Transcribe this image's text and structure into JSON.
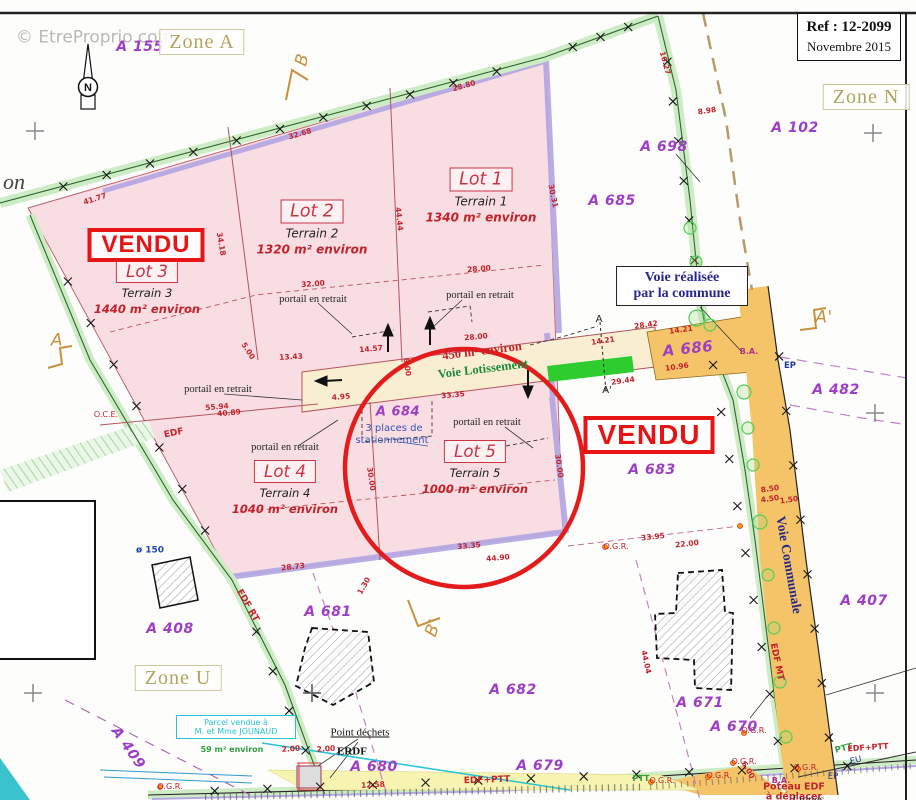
{
  "palette": {
    "pink": "#f8dee2",
    "lot_line": "#c06570",
    "purple_strip": "#b6a9e3",
    "hedge": "#cdebc5",
    "road_cream": "#f9eed2",
    "road_orange": "#f6c468",
    "bright_green": "#2ecc2e",
    "red_stamp": "#e61414",
    "parcel_purple": "#9d3fc4",
    "dim_red": "#c2232d",
    "dark_blue": "#28288c",
    "zone_tan": "#b3a25e",
    "cyan": "#27c4d4"
  },
  "header": {
    "watermark": "© EtreProprio.com",
    "ref_line1": "Ref :   12-2099",
    "ref_line2": "Novembre 2015"
  },
  "legend": {
    "line1": "ssement",
    "line2": "strale"
  },
  "compass": {
    "letter": "N"
  },
  "voie_box": {
    "line1": "Voie réalisée",
    "line2": "par la commune"
  },
  "cyan_box": {
    "line1": "Parcel vendue à",
    "line2": "M. et Mme JOUNAUD"
  },
  "zones": [
    {
      "label": "Zone A",
      "x": 202,
      "y": 42
    },
    {
      "label": "Zone N",
      "x": 866,
      "y": 97
    },
    {
      "label": "Zone U",
      "x": 178,
      "y": 678
    }
  ],
  "stamps": [
    {
      "label": "VENDU",
      "x": 146,
      "y": 245,
      "s": 24
    },
    {
      "label": "VENDU",
      "x": 649,
      "y": 435,
      "s": 28
    }
  ],
  "lots": [
    {
      "name": "Lot 1",
      "terrain": "Terrain 1",
      "area": "1340 m² environ",
      "x": 481,
      "y": 196,
      "s": 12
    },
    {
      "name": "Lot 2",
      "terrain": "Terrain 2",
      "area": "1320 m² environ",
      "x": 312,
      "y": 228,
      "s": 12
    },
    {
      "name": "Lot 3",
      "terrain": "Terrain 3",
      "area": "1440 m² environ",
      "x": 147,
      "y": 288,
      "s": 11.5
    },
    {
      "name": "Lot 4",
      "terrain": "Terrain 4",
      "area": "1040 m² environ",
      "x": 285,
      "y": 488,
      "s": 11.5
    },
    {
      "name": "Lot 5",
      "terrain": "Terrain 5",
      "area": "1000 m² environ",
      "x": 475,
      "y": 468,
      "s": 11.5
    }
  ],
  "parcels": [
    {
      "t": "A 155",
      "x": 140,
      "y": 47
    },
    {
      "t": "A 102",
      "x": 795,
      "y": 128
    },
    {
      "t": "A 698",
      "x": 664,
      "y": 147
    },
    {
      "t": "A 685",
      "x": 612,
      "y": 201
    },
    {
      "t": "A 686",
      "x": 688,
      "y": 349,
      "rot": -6,
      "s": 15
    },
    {
      "t": "A 482",
      "x": 836,
      "y": 390
    },
    {
      "t": "A 683",
      "x": 652,
      "y": 470
    },
    {
      "t": "A 684",
      "x": 398,
      "y": 412,
      "s": 13
    },
    {
      "t": "A 681",
      "x": 328,
      "y": 612
    },
    {
      "t": "A 682",
      "x": 513,
      "y": 690
    },
    {
      "t": "A 680",
      "x": 374,
      "y": 767
    },
    {
      "t": "A 679",
      "x": 540,
      "y": 766
    },
    {
      "t": "A 671",
      "x": 700,
      "y": 703
    },
    {
      "t": "A 670",
      "x": 734,
      "y": 727
    },
    {
      "t": "A 407",
      "x": 864,
      "y": 601
    },
    {
      "t": "A 408",
      "x": 170,
      "y": 629
    },
    {
      "t": "A 409",
      "x": 128,
      "y": 748,
      "rot": 55
    }
  ],
  "labels": [
    {
      "t": "© EtreProprio.com",
      "x": 95,
      "y": 38,
      "c": "rgba(160,160,160,.75)",
      "s": 17
    },
    {
      "t": "on",
      "x": 14,
      "y": 182,
      "c": "#444",
      "s": 22,
      "f": "serifi"
    },
    {
      "t": "A",
      "x": 57,
      "y": 341,
      "c": "#c8913d",
      "s": 17,
      "f": "hand"
    },
    {
      "t": "A'",
      "x": 824,
      "y": 318,
      "c": "#c8913d",
      "s": 17,
      "f": "hand"
    },
    {
      "t": "B",
      "x": 303,
      "y": 60,
      "c": "#c8913d",
      "s": 17,
      "rot": -75,
      "f": "hand"
    },
    {
      "t": "B'",
      "x": 434,
      "y": 628,
      "c": "#c8913d",
      "s": 17,
      "rot": -70,
      "f": "hand"
    },
    {
      "t": "A",
      "x": 599,
      "y": 320,
      "c": "#222",
      "s": 10
    },
    {
      "t": "A'",
      "x": 607,
      "y": 391,
      "c": "#222",
      "s": 10
    },
    {
      "t": "450 m² environ",
      "x": 482,
      "y": 351,
      "c": "#c2232d",
      "s": 12.5,
      "rot": -7,
      "b": 1,
      "f": "serif"
    },
    {
      "t": "Voie Lotissement",
      "x": 483,
      "y": 369,
      "c": "#1d8a3c",
      "s": 12.5,
      "rot": -7,
      "b": 1,
      "f": "serif"
    },
    {
      "t": "3 places de",
      "x": 394,
      "y": 429,
      "c": "#3a52b4",
      "s": 10
    },
    {
      "t": "stationnement",
      "x": 392,
      "y": 441,
      "c": "#3a52b4",
      "s": 10
    },
    {
      "t": "portail en retrait",
      "x": 313,
      "y": 300,
      "c": "#222",
      "s": 10.5,
      "f": "serif"
    },
    {
      "t": "portail en retrait",
      "x": 480,
      "y": 296,
      "c": "#222",
      "s": 10.5,
      "f": "serif"
    },
    {
      "t": "portail en retrait",
      "x": 218,
      "y": 390,
      "c": "#222",
      "s": 10.5,
      "f": "serif"
    },
    {
      "t": "portail en retrait",
      "x": 285,
      "y": 448,
      "c": "#222",
      "s": 10.5,
      "f": "serif"
    },
    {
      "t": "portail en retrait",
      "x": 487,
      "y": 423,
      "c": "#222",
      "s": 10.5,
      "f": "serif"
    },
    {
      "t": "Voie Communale",
      "x": 789,
      "y": 565,
      "c": "#28288c",
      "s": 13.5,
      "rot": 80,
      "b": 1,
      "f": "serif"
    },
    {
      "t": "Point déchets",
      "x": 360,
      "y": 733,
      "c": "#111",
      "s": 11,
      "f": "serif",
      "u": 1
    },
    {
      "t": "ERDF",
      "x": 352,
      "y": 752,
      "c": "#111",
      "s": 11,
      "b": 1,
      "f": "serif"
    },
    {
      "t": "EDF+PTT",
      "x": 487,
      "y": 781,
      "c": "#c2232d",
      "s": 9,
      "rot": -2,
      "b": 1
    },
    {
      "t": "EDF MT",
      "x": 776,
      "y": 662,
      "c": "#c2232d",
      "s": 9,
      "rot": 78,
      "b": 1
    },
    {
      "t": "EDF RT",
      "x": 247,
      "y": 606,
      "c": "#c2232d",
      "s": 9,
      "rot": 60,
      "b": 1
    },
    {
      "t": "O.C.E.",
      "x": 106,
      "y": 415,
      "c": "#c2232d",
      "s": 8
    },
    {
      "t": "EDF",
      "x": 174,
      "y": 434,
      "c": "#c2232d",
      "s": 9,
      "rot": -12,
      "b": 1
    },
    {
      "t": "O.G.R.",
      "x": 616,
      "y": 547,
      "c": "#c2232d",
      "s": 8
    },
    {
      "t": "O.G.R.",
      "x": 754,
      "y": 731,
      "c": "#c2232d",
      "s": 8
    },
    {
      "t": "O.G.R.",
      "x": 744,
      "y": 762,
      "c": "#c2232d",
      "s": 8
    },
    {
      "t": "O.G.R.",
      "x": 719,
      "y": 776,
      "c": "#c2232d",
      "s": 8
    },
    {
      "t": "O.G.R.",
      "x": 662,
      "y": 781,
      "c": "#c2232d",
      "s": 8
    },
    {
      "t": "O.G.R.",
      "x": 806,
      "y": 768,
      "c": "#c2232d",
      "s": 8
    },
    {
      "t": "O.G.R.",
      "x": 170,
      "y": 787,
      "c": "#c2232d",
      "s": 8
    },
    {
      "t": "PTT",
      "x": 844,
      "y": 749,
      "c": "#2f9e3f",
      "s": 8.5,
      "rot": -14,
      "b": 1
    },
    {
      "t": "PTT",
      "x": 641,
      "y": 779,
      "c": "#2f9e3f",
      "s": 8,
      "b": 1
    },
    {
      "t": "EU",
      "x": 856,
      "y": 761,
      "c": "#223a9e",
      "s": 8.5,
      "rot": -14
    },
    {
      "t": "EP",
      "x": 833,
      "y": 777,
      "c": "#223a9e",
      "s": 8.5
    },
    {
      "t": "EP",
      "x": 790,
      "y": 366,
      "c": "#223a9e",
      "s": 8.5,
      "b": 1
    },
    {
      "t": "B.A.",
      "x": 749,
      "y": 352,
      "c": "#b0308a",
      "s": 8,
      "b": 1
    },
    {
      "t": "B.A.",
      "x": 781,
      "y": 781,
      "c": "#b0308a",
      "s": 8,
      "b": 1
    },
    {
      "t": "Poteau EDF",
      "x": 794,
      "y": 787,
      "c": "#c2232d",
      "s": 9.5,
      "b": 1
    },
    {
      "t": "à déplacer",
      "x": 794,
      "y": 797,
      "c": "#c2232d",
      "s": 9.5,
      "b": 1
    },
    {
      "t": "Lignes",
      "x": 808,
      "y": 799,
      "c": "#222",
      "s": 12,
      "f": "serifi"
    },
    {
      "t": "ø 150",
      "x": 150,
      "y": 551,
      "c": "#2244bb",
      "s": 9,
      "b": 1
    },
    {
      "t": "59 m² environ",
      "x": 232,
      "y": 750,
      "c": "#2f9e3f",
      "s": 8,
      "b": 1
    },
    {
      "t": "ssement",
      "x": 32,
      "y": 545,
      "c": "#111",
      "s": 15,
      "f": "serif"
    },
    {
      "t": "strale",
      "x": 24,
      "y": 574,
      "c": "#111",
      "s": 15,
      "f": "serif"
    },
    {
      "t": "EDF+PTT",
      "x": 868,
      "y": 748,
      "c": "#c2232d",
      "s": 8,
      "rot": -4,
      "b": 1
    }
  ],
  "dims": [
    {
      "t": "41.77",
      "x": 95,
      "y": 199,
      "rot": -18
    },
    {
      "t": "32.68",
      "x": 300,
      "y": 134,
      "rot": -16
    },
    {
      "t": "28.80",
      "x": 464,
      "y": 86,
      "rot": -16
    },
    {
      "t": "34.18",
      "x": 221,
      "y": 244,
      "rot": 80
    },
    {
      "t": "44.44",
      "x": 399,
      "y": 219,
      "rot": 84
    },
    {
      "t": "32.00",
      "x": 313,
      "y": 284,
      "rot": -4
    },
    {
      "t": "28.00",
      "x": 479,
      "y": 269,
      "rot": -4
    },
    {
      "t": "13.43",
      "x": 291,
      "y": 357,
      "rot": -3
    },
    {
      "t": "5.00",
      "x": 248,
      "y": 351,
      "rot": 58
    },
    {
      "t": "55.94",
      "x": 217,
      "y": 407,
      "rot": -5
    },
    {
      "t": "40.89",
      "x": 229,
      "y": 413,
      "rot": -5
    },
    {
      "t": "14.57",
      "x": 371,
      "y": 349,
      "rot": -5
    },
    {
      "t": "8.00",
      "x": 407,
      "y": 367,
      "rot": 82
    },
    {
      "t": "28.00",
      "x": 476,
      "y": 337,
      "rot": -5
    },
    {
      "t": "33.35",
      "x": 453,
      "y": 395,
      "rot": -5
    },
    {
      "t": "4.95",
      "x": 341,
      "y": 397,
      "rot": -5
    },
    {
      "t": "28.42",
      "x": 646,
      "y": 325,
      "rot": -8
    },
    {
      "t": "14.21",
      "x": 681,
      "y": 330,
      "rot": -8
    },
    {
      "t": "14.21",
      "x": 603,
      "y": 341,
      "rot": -8
    },
    {
      "t": "10.96",
      "x": 677,
      "y": 367,
      "rot": -8
    },
    {
      "t": "29.44",
      "x": 623,
      "y": 381,
      "rot": -8
    },
    {
      "t": "30.00",
      "x": 371,
      "y": 479,
      "rot": 82
    },
    {
      "t": "30.00",
      "x": 559,
      "y": 466,
      "rot": 82
    },
    {
      "t": "33.35",
      "x": 469,
      "y": 546,
      "rot": -5
    },
    {
      "t": "44.90",
      "x": 498,
      "y": 558,
      "rot": -5
    },
    {
      "t": "33.95",
      "x": 653,
      "y": 537,
      "rot": -6
    },
    {
      "t": "22.00",
      "x": 687,
      "y": 544,
      "rot": -6
    },
    {
      "t": "28.73",
      "x": 293,
      "y": 567,
      "rot": -6
    },
    {
      "t": "12.58",
      "x": 373,
      "y": 785,
      "rot": -3
    },
    {
      "t": "8.50",
      "x": 770,
      "y": 489,
      "rot": -8
    },
    {
      "t": "4.50",
      "x": 770,
      "y": 499,
      "rot": -8
    },
    {
      "t": "1.50",
      "x": 789,
      "y": 500,
      "rot": -8
    },
    {
      "t": "44.04",
      "x": 646,
      "y": 662,
      "rot": 78
    },
    {
      "t": "16.27",
      "x": 665,
      "y": 63,
      "rot": 75
    },
    {
      "t": "8.98",
      "x": 707,
      "y": 111,
      "rot": -8
    },
    {
      "t": "30.31",
      "x": 553,
      "y": 196,
      "rot": 78
    },
    {
      "t": "6.00",
      "x": 748,
      "y": 770,
      "rot": 60
    },
    {
      "t": "2.00",
      "x": 291,
      "y": 749,
      "rot": -4
    },
    {
      "t": "2.00",
      "x": 326,
      "y": 749,
      "rot": -4
    },
    {
      "t": "1.30",
      "x": 364,
      "y": 586,
      "rot": -60
    }
  ]
}
